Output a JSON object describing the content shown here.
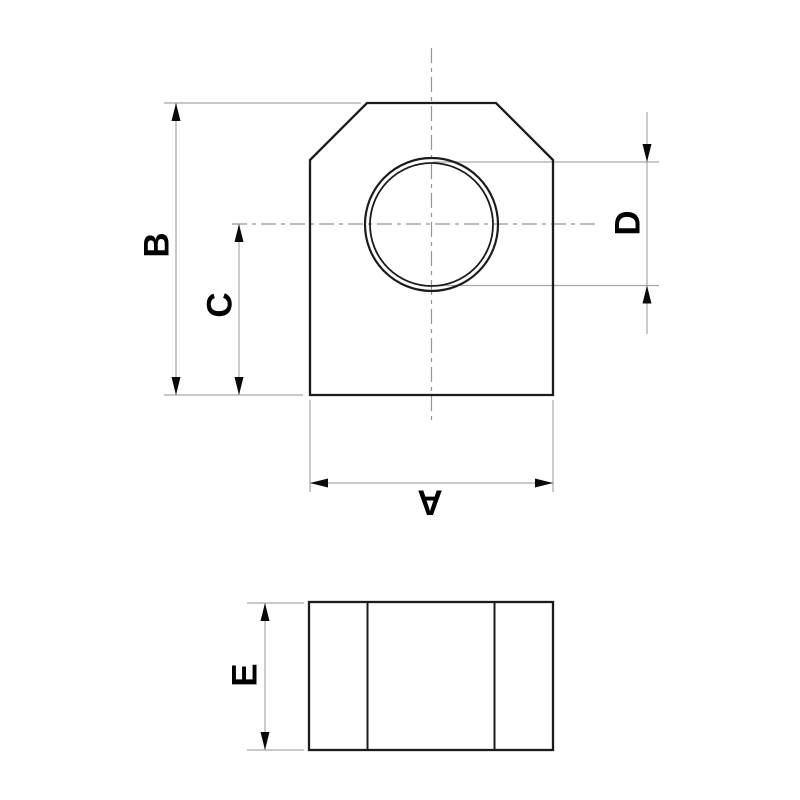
{
  "diagram": {
    "labels": {
      "a": "A",
      "b": "B",
      "c": "C",
      "d": "D",
      "e": "E"
    },
    "colors": {
      "outline": "#1c1c1c",
      "dimension": "#a6a6a6",
      "centerline": "#949494",
      "arrow": "#0a0a0a",
      "label": "#000000",
      "background": "#ffffff"
    }
  }
}
